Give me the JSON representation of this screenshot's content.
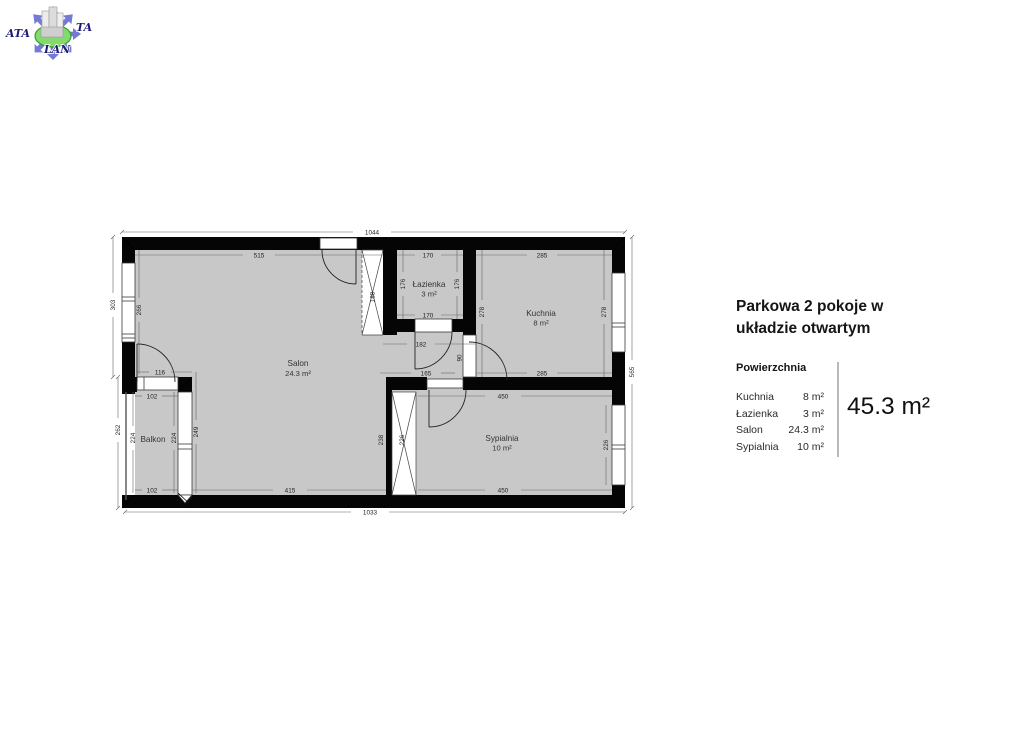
{
  "logo": {
    "text_left": "ATA",
    "text_right": "TA",
    "text_bottom": "LAN"
  },
  "panel": {
    "title": "Parkowa 2 pokoje w układzie otwartym",
    "legend_header": "Powierzchnia",
    "rooms": [
      {
        "label": "Kuchnia",
        "value": "8 m²"
      },
      {
        "label": "Łazienka",
        "value": "3 m²"
      },
      {
        "label": "Salon",
        "value": "24.3 m²"
      },
      {
        "label": "Sypialnia",
        "value": "10 m²"
      }
    ],
    "total": "45.3 m²"
  },
  "plan": {
    "rooms": {
      "salon": {
        "name": "Salon",
        "area": "24.3 m²"
      },
      "lazienka": {
        "name": "Łazienka",
        "area": "3 m²"
      },
      "kuchnia": {
        "name": "Kuchnia",
        "area": "8 m²"
      },
      "sypialnia": {
        "name": "Sypialnia",
        "area": "10 m²"
      },
      "balkon": {
        "name": "Balkon"
      }
    },
    "dims": {
      "overall_top": "1044",
      "overall_bottom": "1033",
      "overall_right": "565",
      "left_upper": "303",
      "left_lower": "262",
      "salon_top": "515",
      "salon_left": "266",
      "salon_bottom": "415",
      "lazienka_top": "170",
      "lazienka_bottom": "170",
      "lazienka_left": "176",
      "lazienka_right": "176",
      "kuchnia_top": "285",
      "kuchnia_bottom": "285",
      "kuchnia_left": "278",
      "kuchnia_right": "278",
      "hall_width": "182",
      "hall_bottom": "165",
      "kitchen_door": "90",
      "wardrobe_hall": "188",
      "wardrobe_bedroom": "226",
      "wardrobe_side": "238",
      "sypialnia_top": "450",
      "sypialnia_bottom": "450",
      "sypialnia_window": "226",
      "balkon_top": "102",
      "balkon_bottom": "102",
      "balkon_left": "224",
      "balkon_right": "224",
      "balkon_glass": "249",
      "balkon_door": "116"
    },
    "colors": {
      "wall": "#0a0a0a",
      "floor": "#c8c8c8",
      "logo_blue": "#767ad4",
      "logo_green": "#85d96f",
      "logo_navy": "#1c1c77",
      "text": "#1f1f1f"
    }
  }
}
